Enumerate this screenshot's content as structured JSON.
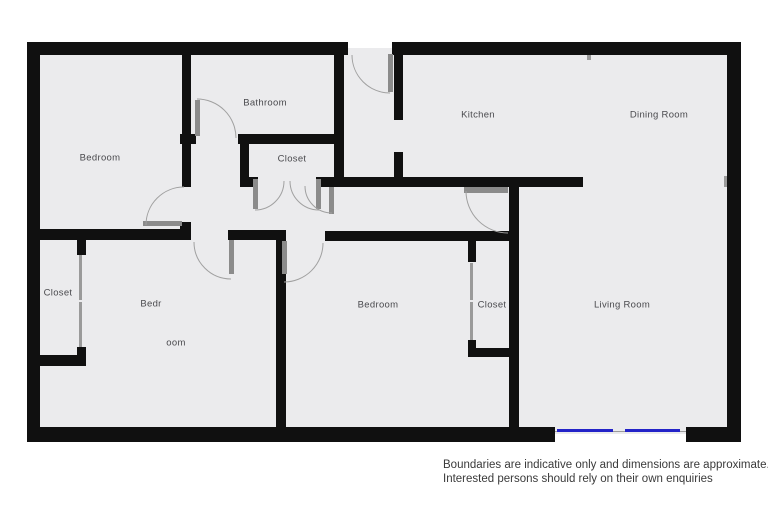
{
  "plan": {
    "labels": [
      {
        "id": "bedroom-1",
        "text": "Bedroom",
        "x": 100,
        "y": 158
      },
      {
        "id": "bathroom",
        "text": "Bathroom",
        "x": 265,
        "y": 103
      },
      {
        "id": "closet-hall",
        "text": "Closet",
        "x": 292,
        "y": 159
      },
      {
        "id": "kitchen",
        "text": "Kitchen",
        "x": 478,
        "y": 115
      },
      {
        "id": "dining-room",
        "text": "Dining Room",
        "x": 659,
        "y": 115
      },
      {
        "id": "closet-left",
        "text": "Closet",
        "x": 58,
        "y": 293
      },
      {
        "id": "bedroom-3-part-1",
        "text": "Bedr",
        "x": 151,
        "y": 304
      },
      {
        "id": "bedroom-3-part-2",
        "text": "oom",
        "x": 176,
        "y": 343
      },
      {
        "id": "bedroom-2",
        "text": "Bedroom",
        "x": 378,
        "y": 305
      },
      {
        "id": "closet-2",
        "text": "Closet",
        "x": 492,
        "y": 305
      },
      {
        "id": "living-room",
        "text": "Living Room",
        "x": 622,
        "y": 305
      }
    ]
  },
  "disclaimer": {
    "line1": "Boundaries are indicative only and dimensions are approximate.",
    "line2": "Interested persons should rely on their own enquiries"
  },
  "colors": {
    "wall": "#101010",
    "floor": "#ebebed",
    "door": "#8b8b8b",
    "slide": "#9a9a9a",
    "arc": "#a0a0a0",
    "window": "#2323c8",
    "sill": "#9a9a9a",
    "label": "#4a4a4e",
    "disclaimer": "#3a3a3a"
  }
}
